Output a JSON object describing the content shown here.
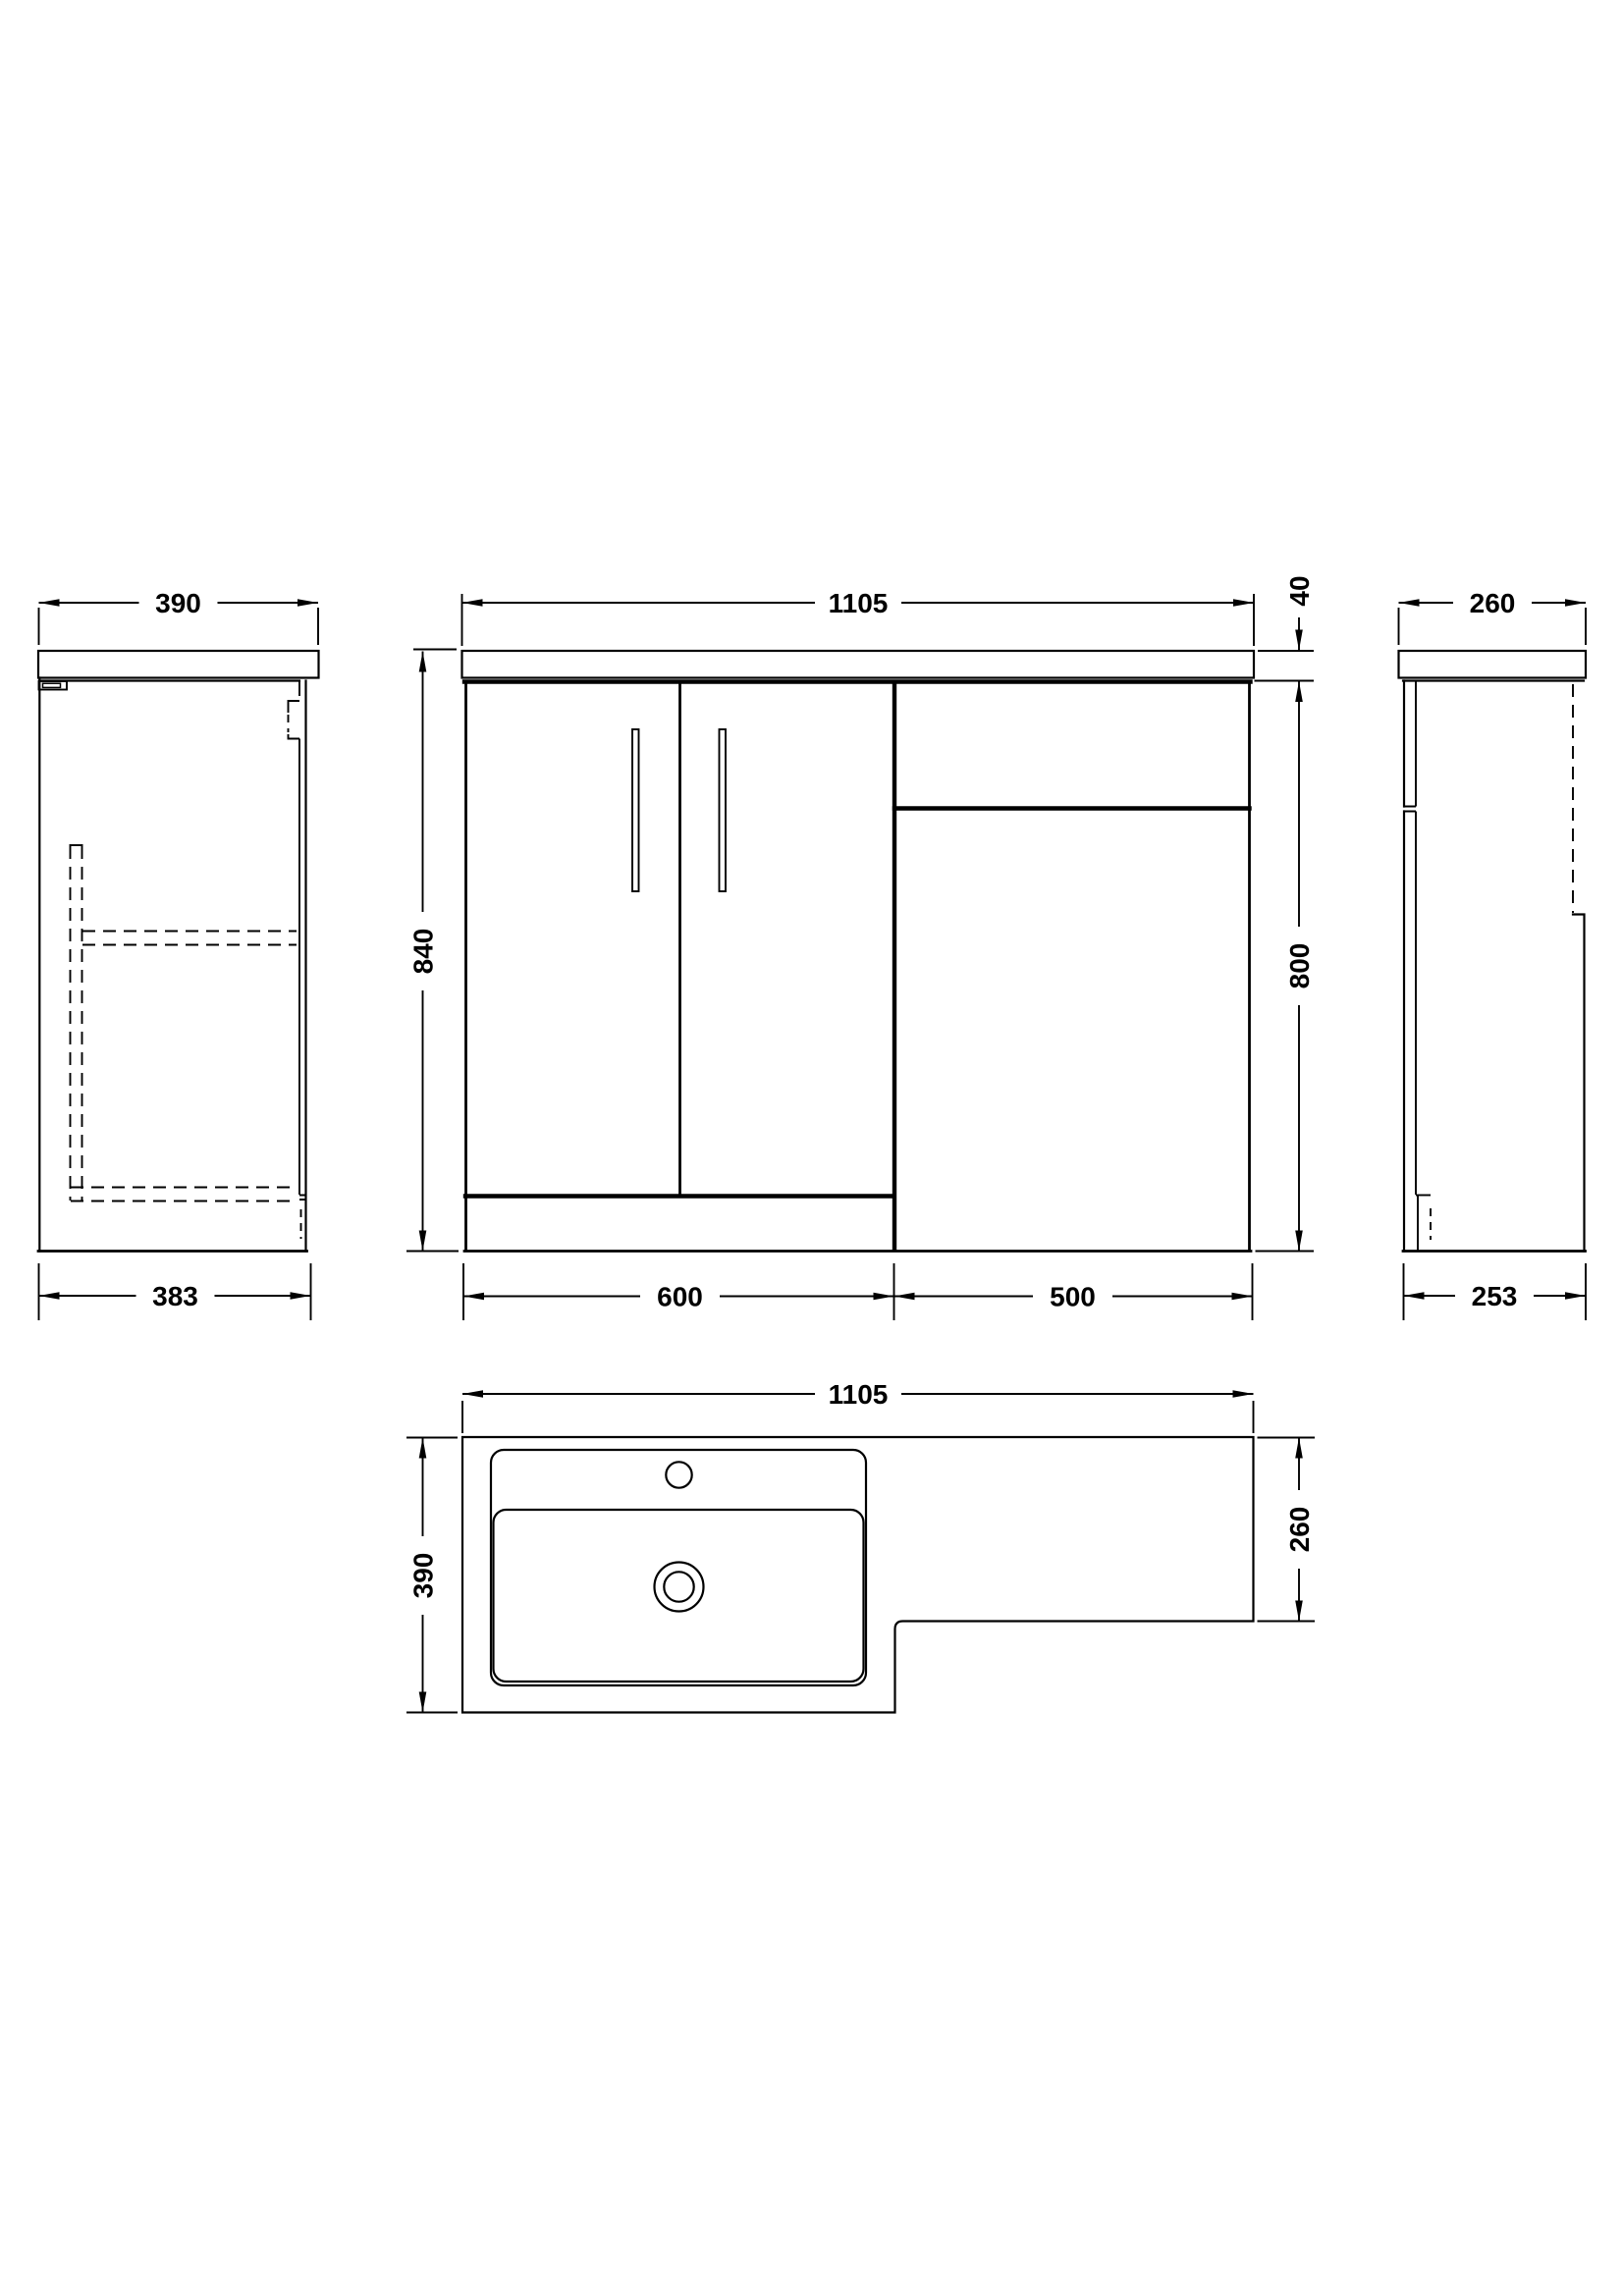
{
  "page": {
    "background": "#ffffff",
    "line_color": "#000000"
  },
  "drawing": {
    "description": "Technical dimension drawing of an L-shaped combination bathroom vanity basin and WC unit: left side view, front view, right side view and plan view",
    "views": {
      "left_side": {
        "label": "left side view",
        "dim_top": "390",
        "dim_bottom": "383"
      },
      "front": {
        "label": "front view",
        "dim_width": "1105",
        "dim_height_left": "840",
        "dim_worktop": "40",
        "dim_height_right": "800",
        "dim_vanity": "600",
        "dim_wc": "500"
      },
      "right_side": {
        "label": "right side view",
        "dim_top": "260",
        "dim_bottom": "253"
      },
      "plan": {
        "label": "plan view",
        "dim_width": "1105",
        "dim_depth": "390",
        "dim_depth_right": "260"
      }
    }
  }
}
